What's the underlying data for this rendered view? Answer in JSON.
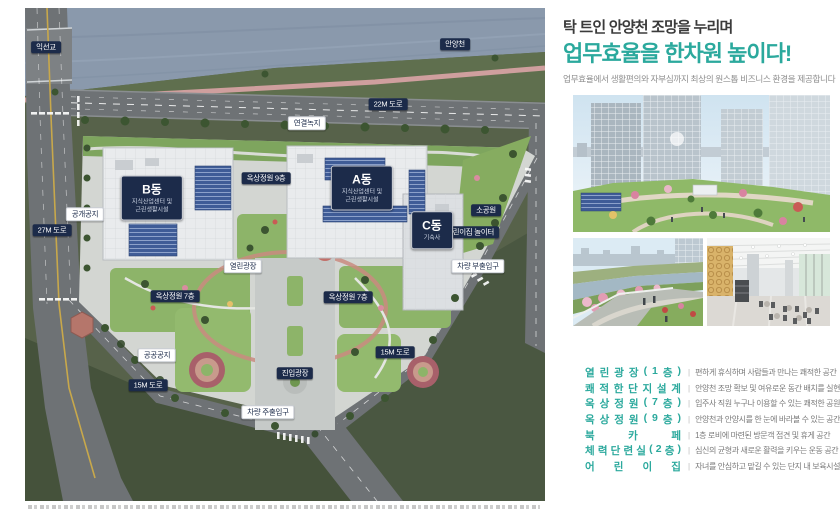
{
  "header": {
    "line1": "탁 트인 안양천 조망을 누리며",
    "line2": "업무효율을 한차원 높이다!",
    "line3": "업무효율에서 생활편의와 자부심까지 최상의 원스톱 비즈니스 환경을 제공합니다"
  },
  "colors": {
    "accent": "#2BA99D",
    "label_navy": "#1C2B4A"
  },
  "map": {
    "labels": [
      {
        "text": "익선교",
        "x": 21,
        "y": 39,
        "style": "dark"
      },
      {
        "text": "안양천",
        "x": 430,
        "y": 36,
        "style": "dark"
      },
      {
        "text": "22M 도로",
        "x": 363,
        "y": 96,
        "style": "dark"
      },
      {
        "text": "연결녹지",
        "x": 282,
        "y": 115,
        "style": "light"
      },
      {
        "text": "옥상정원 9층",
        "x": 241,
        "y": 170,
        "style": "dark"
      },
      {
        "text": "공개공지",
        "x": 60,
        "y": 206,
        "style": "light"
      },
      {
        "text": "27M 도로",
        "x": 27,
        "y": 222,
        "style": "dark"
      },
      {
        "text": "소공원",
        "x": 461,
        "y": 202,
        "style": "dark"
      },
      {
        "text": "어린이집 놀이터",
        "x": 445,
        "y": 224,
        "style": "dark"
      },
      {
        "text": "차량 부출입구",
        "x": 453,
        "y": 258,
        "style": "light"
      },
      {
        "text": "열린광장",
        "x": 218,
        "y": 258,
        "style": "light"
      },
      {
        "text": "옥상정원 7층",
        "x": 150,
        "y": 288,
        "style": "dark"
      },
      {
        "text": "옥상정원 7층",
        "x": 323,
        "y": 289,
        "style": "dark"
      },
      {
        "text": "15M 도로",
        "x": 370,
        "y": 344,
        "style": "dark"
      },
      {
        "text": "공공공지",
        "x": 132,
        "y": 347,
        "style": "light"
      },
      {
        "text": "진입광장",
        "x": 270,
        "y": 365,
        "style": "dark"
      },
      {
        "text": "15M 도로",
        "x": 123,
        "y": 377,
        "style": "dark"
      },
      {
        "text": "차량 주출입구",
        "x": 243,
        "y": 404,
        "style": "light"
      }
    ],
    "buildings": [
      {
        "name": "B동",
        "lines": [
          "지식산업센터 및",
          "근린생활시설"
        ],
        "x": 127,
        "y": 190
      },
      {
        "name": "A동",
        "lines": [
          "지식산업센터 및",
          "근린생활시설"
        ],
        "x": 337,
        "y": 180
      },
      {
        "name": "C동",
        "lines": [
          "기숙사"
        ],
        "x": 407,
        "y": 222
      }
    ]
  },
  "features": {
    "separator": "|",
    "rows": [
      {
        "title": "열린광장(1층)",
        "desc": "편하게 휴식하며 사람들과 만나는 쾌적한 공간"
      },
      {
        "title": "쾌적한 단지설계",
        "desc": "안양천 조망 확보 및 여유로운 동간 배치를 실현"
      },
      {
        "title": "옥상정원(7층)",
        "desc": "입주사 직원 누구나 이용할 수 있는 쾌적한 공원"
      },
      {
        "title": "옥상정원(9층)",
        "desc": "안양천과 안양시를 한 눈에 바라볼 수 있는 공간"
      },
      {
        "title": "북카페",
        "desc": "1층 로비에 마련된 방문객 접견 및 휴게 공간"
      },
      {
        "title": "체력단련실(2층)",
        "desc": "심신의 균형과 새로운 활력을 키우는 운동 공간"
      },
      {
        "title": "어린이집",
        "desc": "자녀를 안심하고 맡길 수 있는 단지 내 보육시설"
      }
    ]
  }
}
